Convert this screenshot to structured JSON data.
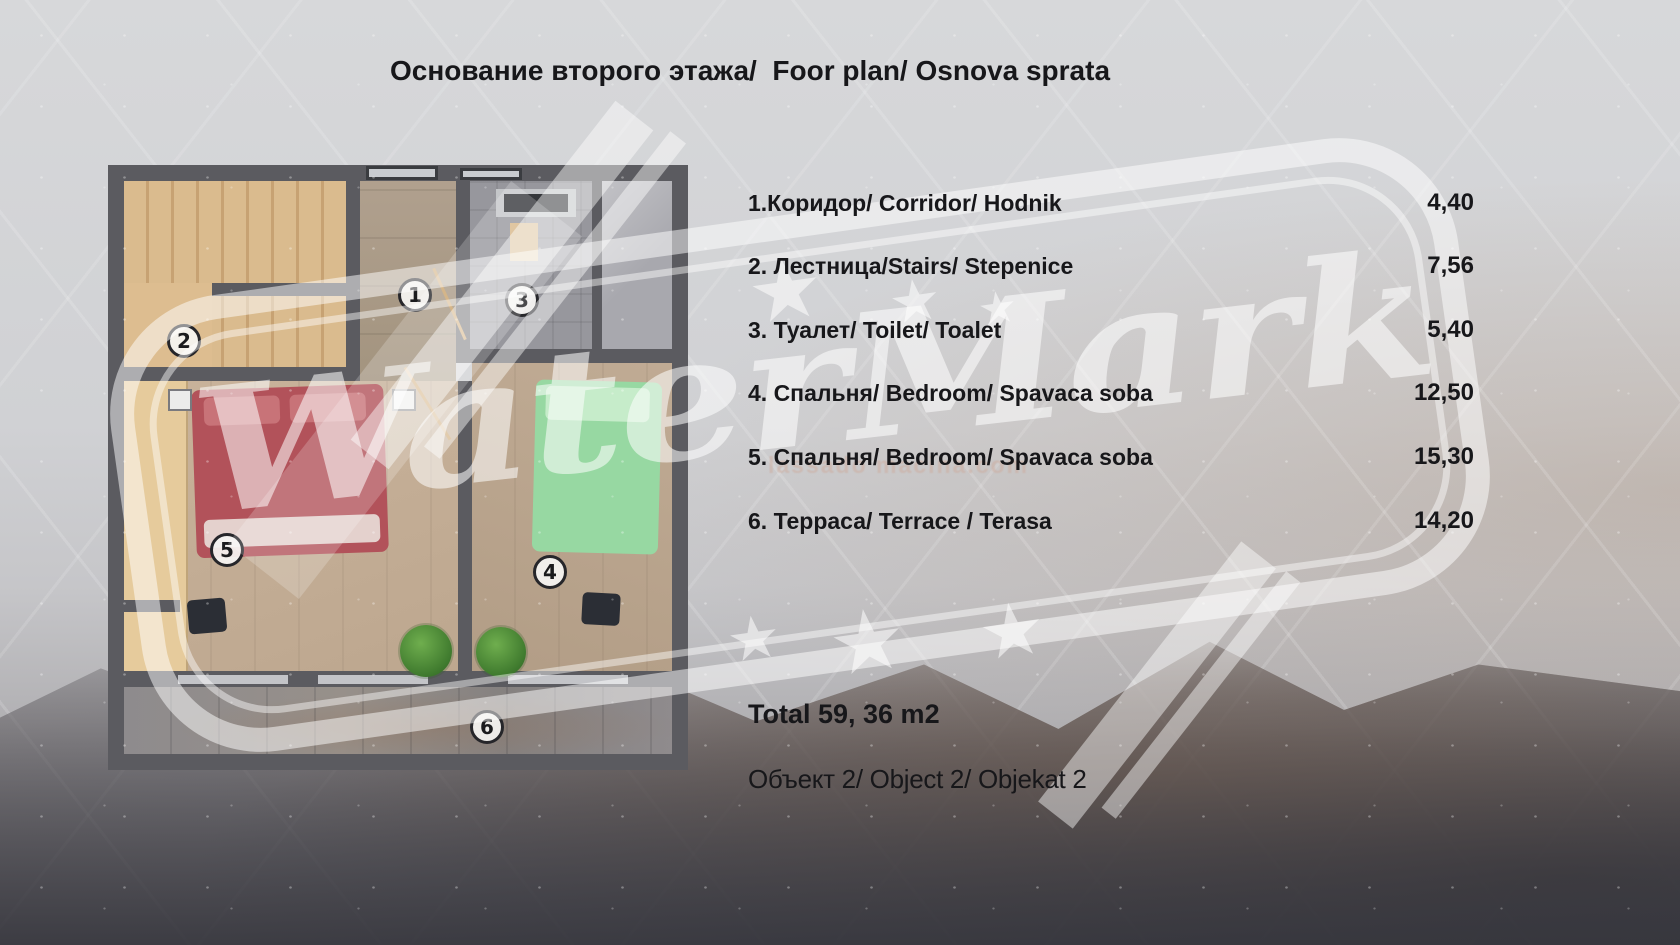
{
  "title": "Основание второго этажа/  Foor plan/ Osnova sprata",
  "legend": {
    "rows": [
      {
        "label": "1.Коридор/ Corridor/ Hodnik",
        "value": "4,40"
      },
      {
        "label": "2. Лестница/Stairs/ Stepenice",
        "value": "7,56"
      },
      {
        "label": "3. Туалет/ Toilet/ Toalet",
        "value": "5,40"
      },
      {
        "label": "4. Спальня/ Bedroom/ Spavaca soba",
        "value": "12,50"
      },
      {
        "label": "5. Спальня/ Bedroom/ Spavaca soba",
        "value": "15,30"
      },
      {
        "label": "6. Терраса/ Terrace / Terasa",
        "value": "14,20"
      }
    ],
    "total_label": "Total 59, 36 m2",
    "object_label": "Объект 2/ Object 2/ Objekat 2"
  },
  "floor_plan": {
    "rooms": [
      {
        "number": "1",
        "name": "corridor"
      },
      {
        "number": "2",
        "name": "stairs"
      },
      {
        "number": "3",
        "name": "toilet"
      },
      {
        "number": "4",
        "name": "bedroom"
      },
      {
        "number": "5",
        "name": "bedroom"
      },
      {
        "number": "6",
        "name": "terrace"
      }
    ]
  },
  "watermark": {
    "text": "WaterMark",
    "url_text": "lassado macina.com"
  },
  "colors": {
    "wall": "#5b5b60",
    "wood": "#d9b98c",
    "bed-red": "#b2525a",
    "bed-green": "#97d8a2",
    "plant-green": "#3f7a2e",
    "text": "#17171a",
    "background": "#d0d1d4",
    "watermark-white": "#ffffff"
  }
}
